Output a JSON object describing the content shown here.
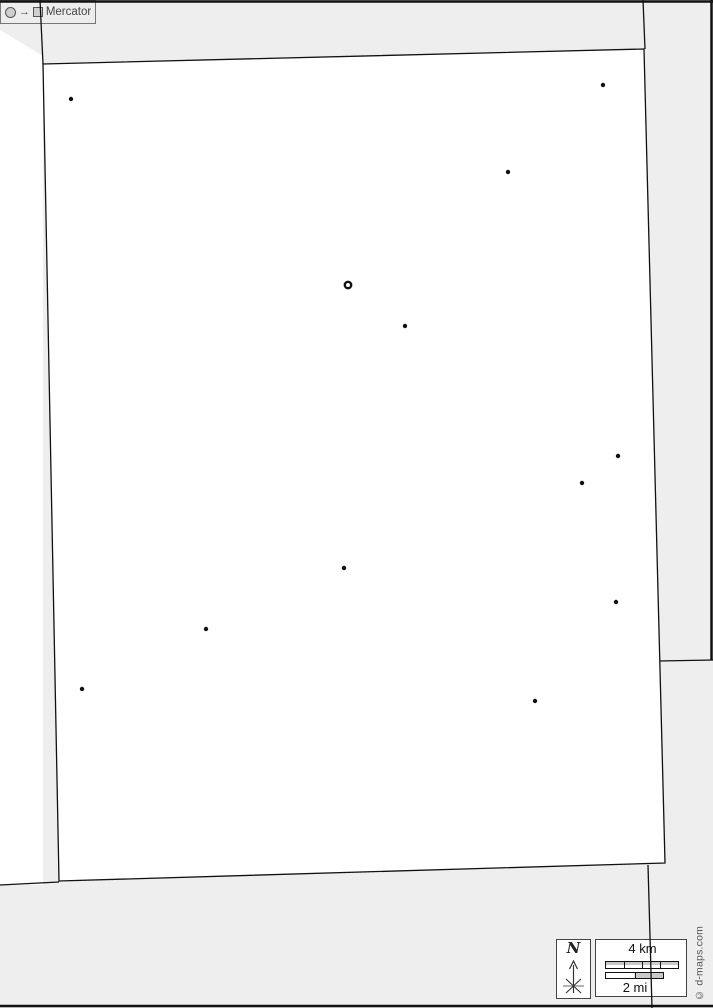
{
  "map": {
    "background_color": "#eeeeee",
    "region_fill": "#ffffff",
    "outside_fill": "#ffffff",
    "boundary_color": "#111111",
    "markers": {
      "capital": {
        "x": 348,
        "y": 285
      },
      "cities": [
        {
          "x": 71,
          "y": 99
        },
        {
          "x": 603,
          "y": 85
        },
        {
          "x": 508,
          "y": 172
        },
        {
          "x": 405,
          "y": 326
        },
        {
          "x": 618,
          "y": 456
        },
        {
          "x": 582,
          "y": 483
        },
        {
          "x": 344,
          "y": 568
        },
        {
          "x": 616,
          "y": 602
        },
        {
          "x": 206,
          "y": 629
        },
        {
          "x": 82,
          "y": 689
        },
        {
          "x": 535,
          "y": 701
        }
      ]
    }
  },
  "compass": {
    "north_label": "N"
  },
  "scale_bar": {
    "km_label": "4 km",
    "mi_label": "2 mi"
  },
  "projection": {
    "arrow_symbol": "→",
    "label": "Mercator"
  },
  "credit": {
    "label": "© d-maps.com"
  }
}
